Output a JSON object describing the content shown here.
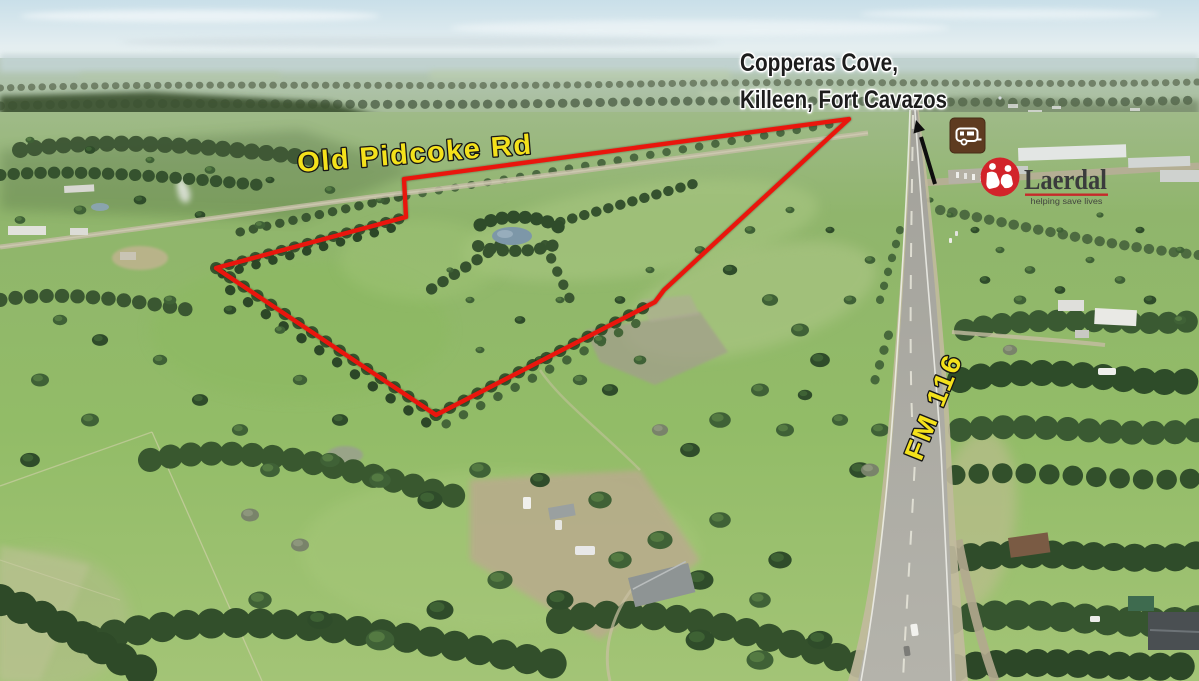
{
  "labels": {
    "destination": {
      "line1": "Copperas Cove,",
      "line2": "Killeen, Fort Cavazos"
    },
    "roads": {
      "old_pidcoke_rd": "Old Pidcoke Rd",
      "fm_116": "FM 116"
    }
  },
  "brand": {
    "name": "Laerdal",
    "tagline": "helping save lives"
  },
  "boundary": {
    "points": "849,119 404,179 406,217 216,268 436,415 655,302 664,290",
    "color": "#e9190e"
  },
  "icons": {
    "rv_sign": "camper-trailer-sign",
    "direction_arrow": "arrow-up-along-highway"
  },
  "colors": {
    "boundary_red": "#e9190e",
    "road_label_yellow": "#f4e11b",
    "rv_sign_brown": "#5e3b20",
    "laerdal_red": "#d2232a",
    "destination_text": "#1d1d1d",
    "destination_halo": "#ffffff"
  }
}
